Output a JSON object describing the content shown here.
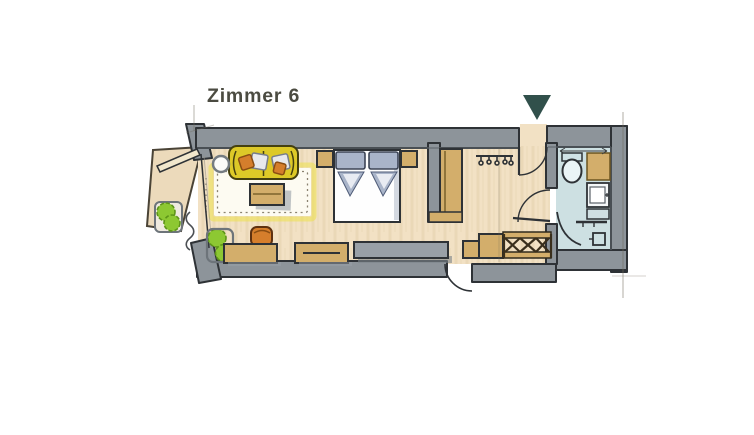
{
  "page": {
    "background": "#ffffff"
  },
  "header": {
    "room_label": "Zimmer 6",
    "label_color": "#4b4b41"
  },
  "entrance_marker": {
    "icon": "triangle-down-icon",
    "color": "#31504b"
  },
  "plan": {
    "type": "hand-drawn hotel room floor plan",
    "colors": {
      "wall": "#8d949a",
      "wall_outline": "#2e3236",
      "floor": "#f2e1c4",
      "balcony_floor": "#ecdabb",
      "bathroom_floor": "#cde0e2",
      "rug": "#fdfbf2",
      "rug_glow": "#ece24b",
      "sofa": "#ddc928",
      "wood": "#d3ae6b",
      "gray_furniture": "#99a0a7",
      "orange": "#d57e2c",
      "green": "#8dc832",
      "bed_gray_blue": "#a9b4c9",
      "ink": "#2f3236",
      "pencil": "#6f695d"
    },
    "areas": [
      "balcony",
      "living-area",
      "sleeping-area",
      "entry-hall",
      "bathroom"
    ],
    "furniture_icons": [
      "balcony-plant",
      "balcony-door",
      "curtain",
      "sofa",
      "sofa-cushions",
      "side-table",
      "rug",
      "coffee-table",
      "pouf",
      "indoor-plants",
      "sideboard",
      "sideboard-with-drawer",
      "media-console",
      "double-bed",
      "bed-pillows",
      "nightstand-left",
      "nightstand-right",
      "divider-wall",
      "wardrobe",
      "coat-hooks",
      "bench",
      "luggage-rack",
      "entrance-door",
      "bathroom-door",
      "connecting-door",
      "toilet",
      "vanity",
      "washbasin",
      "shower",
      "shower-glass-door"
    ]
  }
}
